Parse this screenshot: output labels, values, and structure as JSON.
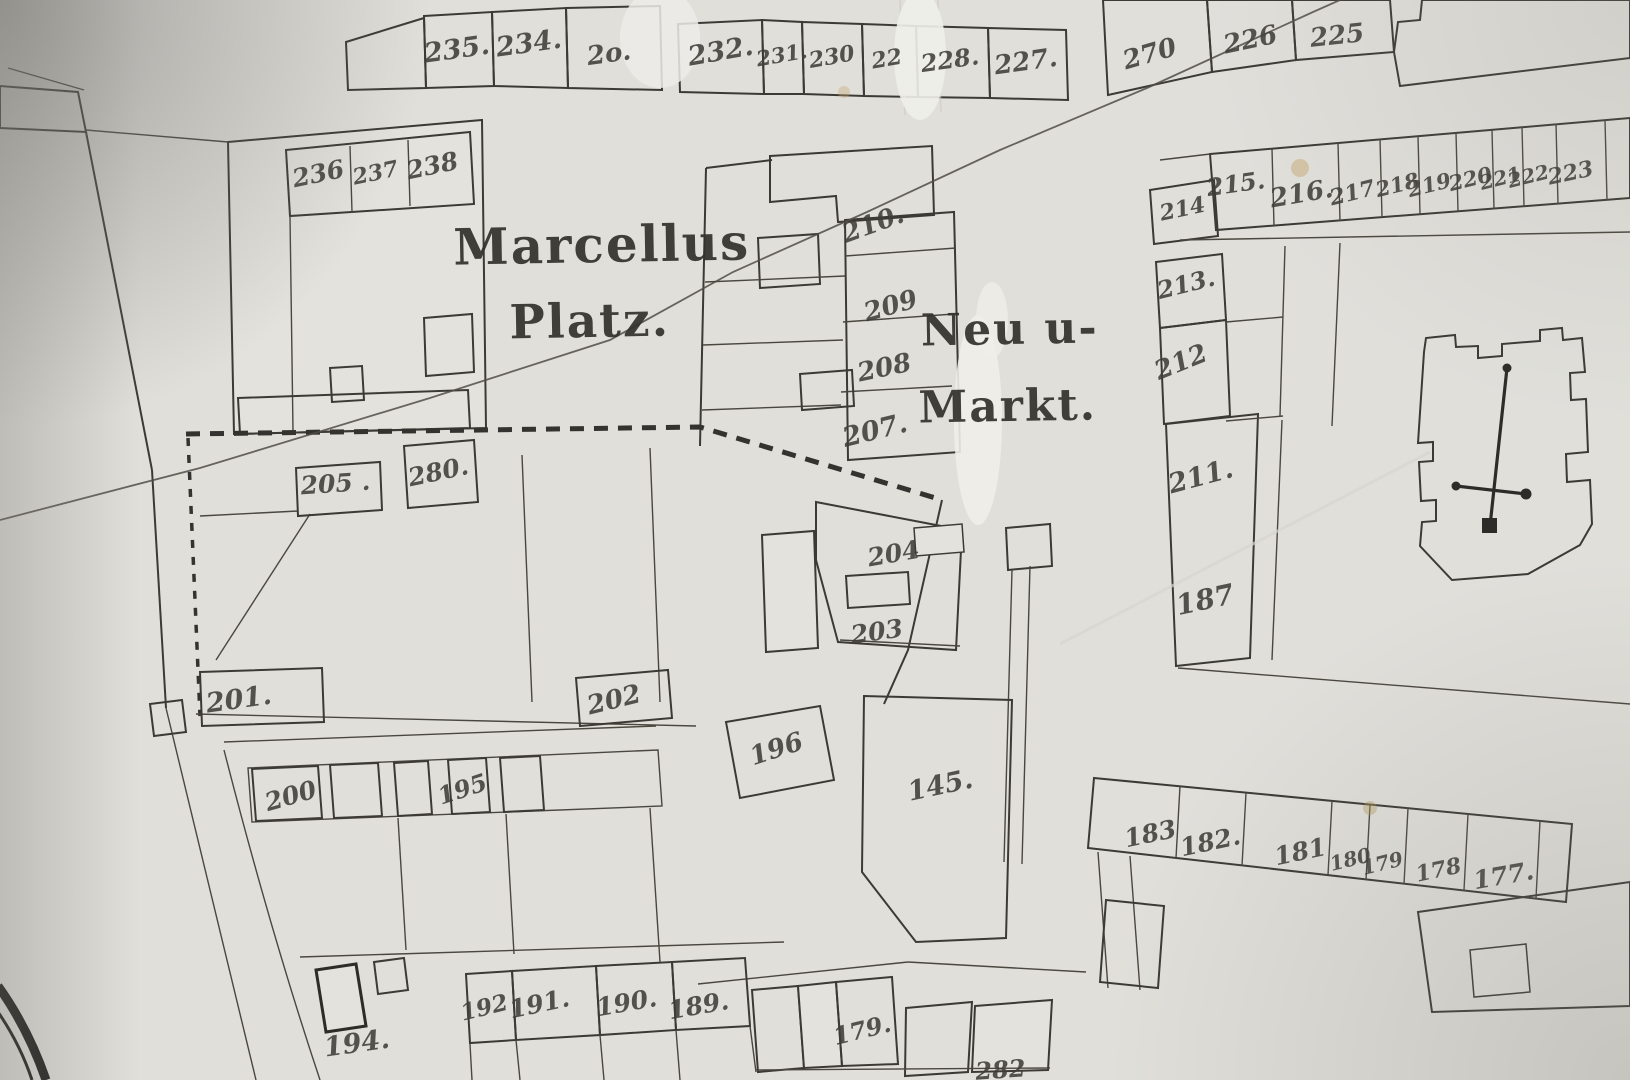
{
  "map": {
    "description": "historical cadastral town map photograph",
    "palette": {
      "paper": "#e0dfda",
      "ink": "#3c3a35",
      "hatch": "#55524a"
    },
    "place_labels": [
      {
        "name": "place-label-marcellus",
        "text": "Marcellus",
        "x": 602,
        "y": 262,
        "rot": -1,
        "size": 50
      },
      {
        "name": "place-label-platz",
        "text": "Platz.",
        "x": 590,
        "y": 337,
        "rot": -1,
        "size": 47
      },
      {
        "name": "place-label-neu-u",
        "text": "Neu u-",
        "x": 1010,
        "y": 344,
        "rot": -1,
        "size": 44
      },
      {
        "name": "place-label-markt",
        "text": "Markt.",
        "x": 1008,
        "y": 421,
        "rot": -1,
        "size": 44
      }
    ],
    "plot_labels": [
      {
        "name": "plot-label-235",
        "text": "235.",
        "x": 458,
        "y": 58,
        "rot": -8,
        "size": 27
      },
      {
        "name": "plot-label-234",
        "text": "234.",
        "x": 530,
        "y": 52,
        "rot": -8,
        "size": 27
      },
      {
        "name": "plot-label-233-worn",
        "text": "2o.",
        "x": 610,
        "y": 62,
        "rot": -8,
        "size": 26
      },
      {
        "name": "plot-label-232",
        "text": "232.",
        "x": 722,
        "y": 60,
        "rot": -10,
        "size": 27
      },
      {
        "name": "plot-label-231",
        "text": "231.",
        "x": 783,
        "y": 62,
        "rot": -10,
        "size": 21
      },
      {
        "name": "plot-label-230",
        "text": "230",
        "x": 833,
        "y": 64,
        "rot": -10,
        "size": 22
      },
      {
        "name": "plot-label-229-worn",
        "text": "22",
        "x": 888,
        "y": 66,
        "rot": -10,
        "size": 22
      },
      {
        "name": "plot-label-228",
        "text": "228.",
        "x": 951,
        "y": 68,
        "rot": -8,
        "size": 24
      },
      {
        "name": "plot-label-227",
        "text": "227.",
        "x": 1027,
        "y": 70,
        "rot": -8,
        "size": 26
      },
      {
        "name": "plot-label-270",
        "text": "270",
        "x": 1152,
        "y": 62,
        "rot": -16,
        "size": 26
      },
      {
        "name": "plot-label-226",
        "text": "226",
        "x": 1252,
        "y": 48,
        "rot": -12,
        "size": 26
      },
      {
        "name": "plot-label-225",
        "text": "225",
        "x": 1338,
        "y": 44,
        "rot": -6,
        "size": 26
      },
      {
        "name": "plot-label-236",
        "text": "236",
        "x": 320,
        "y": 182,
        "rot": -12,
        "size": 25
      },
      {
        "name": "plot-label-237",
        "text": "237",
        "x": 377,
        "y": 180,
        "rot": -12,
        "size": 22
      },
      {
        "name": "plot-label-238",
        "text": "238",
        "x": 434,
        "y": 174,
        "rot": -12,
        "size": 25
      },
      {
        "name": "plot-label-210",
        "text": "210.",
        "x": 876,
        "y": 232,
        "rot": -20,
        "size": 26
      },
      {
        "name": "plot-label-209",
        "text": "209",
        "x": 893,
        "y": 314,
        "rot": -16,
        "size": 26
      },
      {
        "name": "plot-label-208",
        "text": "208",
        "x": 886,
        "y": 376,
        "rot": -12,
        "size": 26
      },
      {
        "name": "plot-label-207",
        "text": "207.",
        "x": 877,
        "y": 439,
        "rot": -14,
        "size": 27
      },
      {
        "name": "plot-label-214",
        "text": "214",
        "x": 1184,
        "y": 216,
        "rot": -12,
        "size": 22
      },
      {
        "name": "plot-label-215",
        "text": "215.",
        "x": 1237,
        "y": 192,
        "rot": -8,
        "size": 24
      },
      {
        "name": "plot-label-216",
        "text": "216.",
        "x": 1303,
        "y": 202,
        "rot": -10,
        "size": 26
      },
      {
        "name": "plot-label-217",
        "text": "217",
        "x": 1354,
        "y": 200,
        "rot": -14,
        "size": 22
      },
      {
        "name": "plot-label-218",
        "text": "218",
        "x": 1399,
        "y": 192,
        "rot": -14,
        "size": 21
      },
      {
        "name": "plot-label-219",
        "text": "219",
        "x": 1431,
        "y": 192,
        "rot": -14,
        "size": 21
      },
      {
        "name": "plot-label-220",
        "text": "220",
        "x": 1472,
        "y": 186,
        "rot": -14,
        "size": 21
      },
      {
        "name": "plot-label-221",
        "text": "221",
        "x": 1502,
        "y": 185,
        "rot": -14,
        "size": 20
      },
      {
        "name": "plot-label-222",
        "text": "222",
        "x": 1530,
        "y": 183,
        "rot": -14,
        "size": 20
      },
      {
        "name": "plot-label-223",
        "text": "223",
        "x": 1572,
        "y": 180,
        "rot": -12,
        "size": 22
      },
      {
        "name": "plot-label-213",
        "text": "213.",
        "x": 1188,
        "y": 292,
        "rot": -14,
        "size": 24
      },
      {
        "name": "plot-label-212",
        "text": "212",
        "x": 1184,
        "y": 370,
        "rot": -22,
        "size": 26
      },
      {
        "name": "plot-label-211",
        "text": "211.",
        "x": 1203,
        "y": 485,
        "rot": -15,
        "size": 27
      },
      {
        "name": "plot-label-187",
        "text": "187",
        "x": 1207,
        "y": 609,
        "rot": -12,
        "size": 28
      },
      {
        "name": "plot-label-205",
        "text": "205 .",
        "x": 336,
        "y": 492,
        "rot": -4,
        "size": 25
      },
      {
        "name": "plot-label-280",
        "text": "280.",
        "x": 440,
        "y": 480,
        "rot": -12,
        "size": 25
      },
      {
        "name": "plot-label-204",
        "text": "204",
        "x": 895,
        "y": 562,
        "rot": -10,
        "size": 25
      },
      {
        "name": "plot-label-203",
        "text": "203",
        "x": 878,
        "y": 640,
        "rot": -8,
        "size": 25
      },
      {
        "name": "plot-label-201",
        "text": "201.",
        "x": 240,
        "y": 708,
        "rot": -8,
        "size": 27
      },
      {
        "name": "plot-label-202",
        "text": "202",
        "x": 616,
        "y": 708,
        "rot": -14,
        "size": 26
      },
      {
        "name": "plot-label-200",
        "text": "200",
        "x": 293,
        "y": 804,
        "rot": -16,
        "size": 25
      },
      {
        "name": "plot-label-195-row",
        "text": "195",
        "x": 465,
        "y": 797,
        "rot": -18,
        "size": 24
      },
      {
        "name": "plot-label-196",
        "text": "196",
        "x": 779,
        "y": 757,
        "rot": -18,
        "size": 26
      },
      {
        "name": "plot-label-145",
        "text": "145.",
        "x": 942,
        "y": 794,
        "rot": -12,
        "size": 27
      },
      {
        "name": "plot-label-183",
        "text": "183",
        "x": 1152,
        "y": 842,
        "rot": -12,
        "size": 25
      },
      {
        "name": "plot-label-182",
        "text": "182.",
        "x": 1212,
        "y": 850,
        "rot": -12,
        "size": 25
      },
      {
        "name": "plot-label-181",
        "text": "181",
        "x": 1302,
        "y": 860,
        "rot": -12,
        "size": 25
      },
      {
        "name": "plot-label-180",
        "text": "180",
        "x": 1352,
        "y": 866,
        "rot": -14,
        "size": 20
      },
      {
        "name": "plot-label-179-row",
        "text": "179",
        "x": 1384,
        "y": 870,
        "rot": -14,
        "size": 20
      },
      {
        "name": "plot-label-178",
        "text": "178",
        "x": 1440,
        "y": 877,
        "rot": -12,
        "size": 22
      },
      {
        "name": "plot-label-177",
        "text": "177.",
        "x": 1505,
        "y": 884,
        "rot": -10,
        "size": 25
      },
      {
        "name": "plot-label-194",
        "text": "194.",
        "x": 358,
        "y": 1052,
        "rot": -8,
        "size": 27
      },
      {
        "name": "plot-label-192",
        "text": "192",
        "x": 486,
        "y": 1015,
        "rot": -14,
        "size": 23
      },
      {
        "name": "plot-label-191",
        "text": "191.",
        "x": 541,
        "y": 1012,
        "rot": -12,
        "size": 25
      },
      {
        "name": "plot-label-190",
        "text": "190.",
        "x": 628,
        "y": 1011,
        "rot": -10,
        "size": 25
      },
      {
        "name": "plot-label-189",
        "text": "189.",
        "x": 700,
        "y": 1014,
        "rot": -10,
        "size": 25
      },
      {
        "name": "plot-label-179-bottom",
        "text": "179.",
        "x": 864,
        "y": 1038,
        "rot": -14,
        "size": 24
      },
      {
        "name": "plot-label-282-clipped",
        "text": "282",
        "x": 1001,
        "y": 1078,
        "rot": -4,
        "size": 24
      }
    ]
  }
}
